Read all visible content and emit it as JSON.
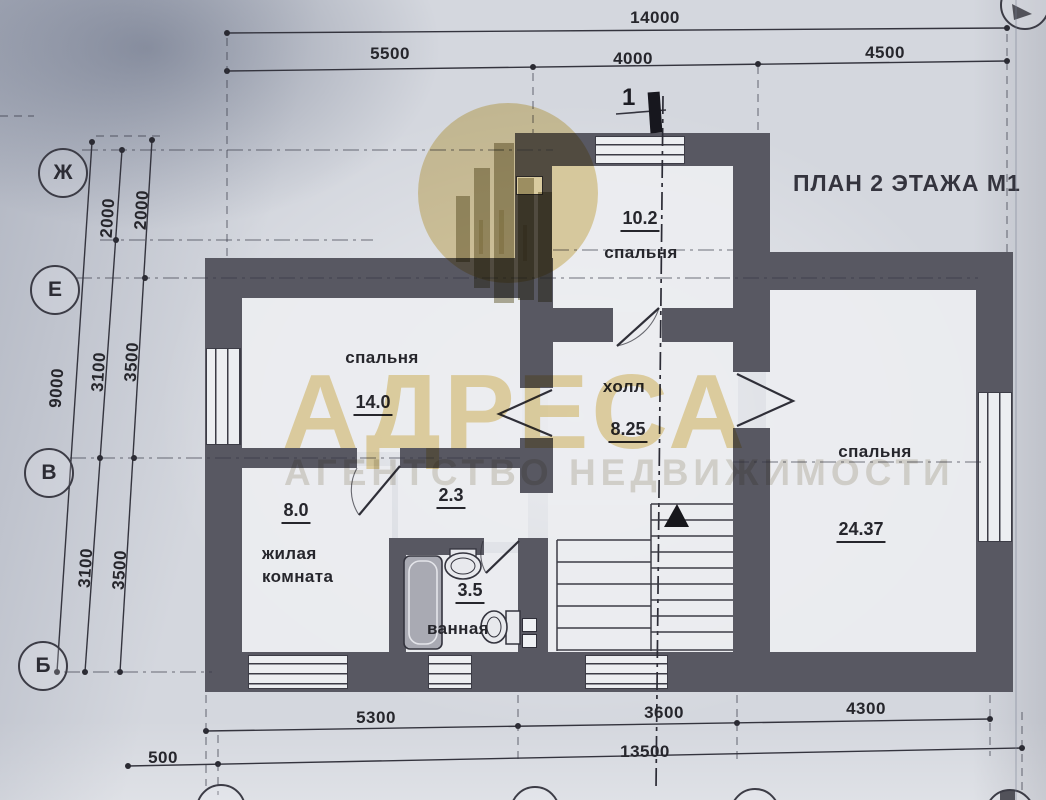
{
  "title": "ПЛАН 2 ЭТАЖА  М1",
  "watermark": {
    "brand": "АДРЕСА",
    "tagline": "АГЕНТСТВО НЕДВИЖИМОСТИ"
  },
  "section": {
    "label": "1"
  },
  "grid_axes": {
    "rows": [
      "Ж",
      "Е",
      "В",
      "Б"
    ]
  },
  "dimensions": {
    "top": {
      "total": "14000",
      "segments": [
        "5500",
        "4000",
        "4500"
      ]
    },
    "left": {
      "outer_total": "9000",
      "chain_mid": [
        "2000",
        "3100",
        "3100"
      ],
      "chain_inner": [
        "2000",
        "3500",
        "3500"
      ]
    },
    "bottom": {
      "segments": [
        "5300",
        "3600",
        "4300"
      ],
      "total": "13500",
      "offset": "500"
    }
  },
  "rooms": {
    "bedroom_top": {
      "name": "спальня",
      "area": "10.2"
    },
    "bedroom_left": {
      "name": "спальня",
      "area": "14.0"
    },
    "hall": {
      "name": "холл",
      "area": "8.25"
    },
    "bedroom_right": {
      "name": "спальня",
      "area": "24.37"
    },
    "living_room": {
      "name": "жилая комната",
      "area": "8.0"
    },
    "corridor": {
      "area": "2.3"
    },
    "bathroom": {
      "name": "ванная",
      "area": "3.5"
    }
  },
  "colors": {
    "wall": "#585862",
    "ink": "#26262c",
    "paper": "#d4d7de",
    "watermark": "#e7d5a0"
  }
}
